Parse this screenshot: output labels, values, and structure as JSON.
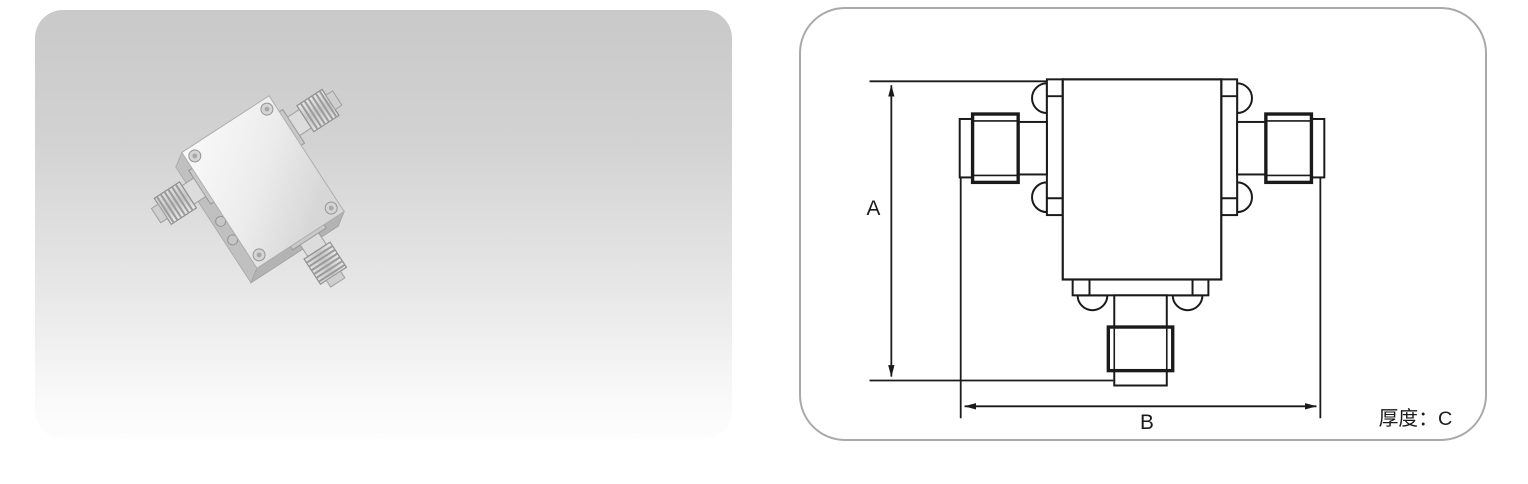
{
  "photo_panel": {
    "content": "product-photo-rf-isolator-three-sma-connectors",
    "background_top_color": "#c9c9c9",
    "background_bottom_color": "#fbfbfb",
    "metal_face_color": "#f2f2f2",
    "metal_side_color": "#bdbdbd"
  },
  "drawing_panel": {
    "border_color": "#a9a9a9",
    "line_color": "#1a1a1a",
    "dimensions": {
      "height_label": "A",
      "width_label": "B",
      "thickness_label": "厚度：C"
    }
  }
}
